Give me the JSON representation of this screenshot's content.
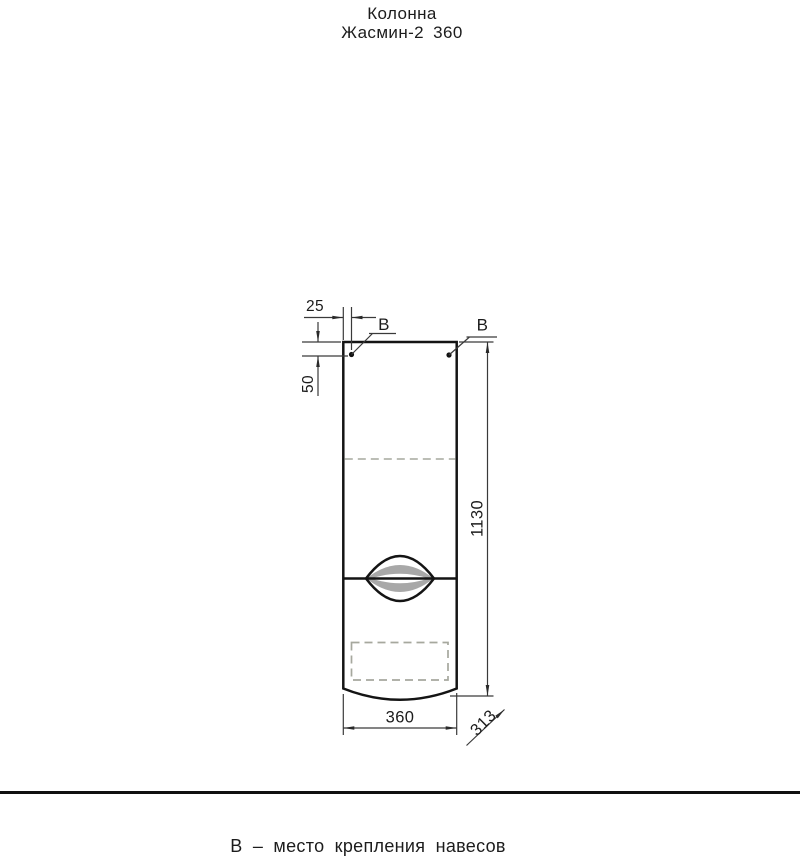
{
  "title": {
    "line1": "Колонна",
    "line2": "Жасмин-2 360"
  },
  "dimensions": {
    "hole_offset_horizontal": "25",
    "hole_offset_vertical": "50",
    "height": "1130",
    "width": "360",
    "depth": "313"
  },
  "mount_labels": {
    "left": "В",
    "right": "В"
  },
  "footer": {
    "note": "В – место крепления навесов"
  },
  "colors": {
    "outline": "#141414",
    "dim_line": "#3a3a3a",
    "dashed": "#a6a89e",
    "handle_shade": "#a8a8a8",
    "background": "#ffffff"
  }
}
